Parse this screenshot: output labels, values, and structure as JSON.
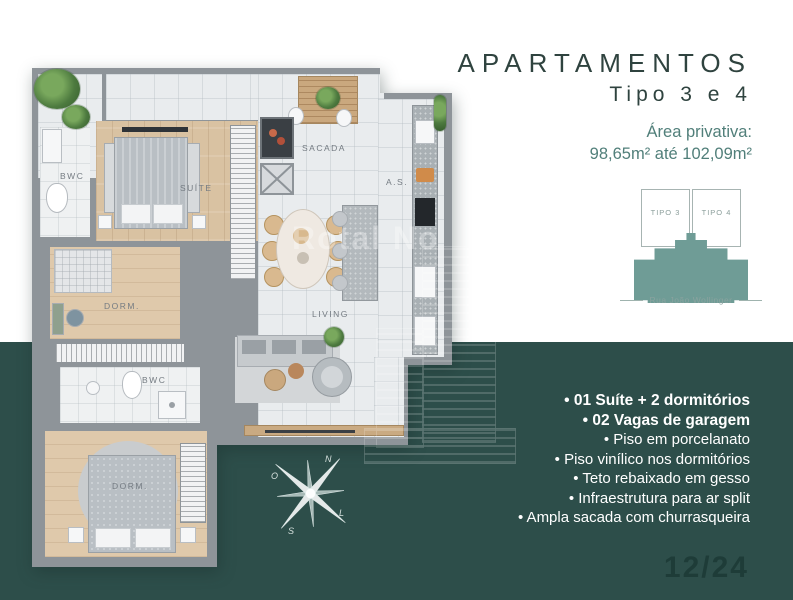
{
  "header": {
    "title": "APARTAMENTOS",
    "subtitle": "Tipo 3 e 4",
    "area_label": "Área privativa:",
    "area_value": "98,65m² até 102,09m²"
  },
  "keyplan": {
    "unit_left": "TIPO 3",
    "unit_right": "TIPO 4",
    "street": "Rua João Wollinger"
  },
  "features": [
    {
      "label": "• 01 Suíte + 2 dormitórios",
      "bold": true
    },
    {
      "label": "• 02 Vagas de garagem",
      "bold": true
    },
    {
      "label": "• Piso em porcelanato",
      "bold": false
    },
    {
      "label": "• Piso vinílico nos dormitórios",
      "bold": false
    },
    {
      "label": "• Teto rebaixado em gesso",
      "bold": false
    },
    {
      "label": "• Infraestrutura para ar split",
      "bold": false
    },
    {
      "label": "• Ampla sacada com churrasqueira",
      "bold": false
    }
  ],
  "floorplan": {
    "rooms": {
      "bwc_suite": "BWC",
      "suite": "SUÍTE",
      "sacada": "SACADA",
      "servico": "A.S.",
      "dorm_mid": "DORM.",
      "living": "LIVING",
      "bwc_social": "BWC",
      "dorm_bottom": "DORM."
    }
  },
  "compass": {
    "north": "N",
    "south": "S",
    "east": "L",
    "west": "O"
  },
  "watermark": {
    "text": "Rotal No"
  },
  "page_number": "12/24",
  "colors": {
    "background_teal": "#2d4e4a",
    "accent_teal": "#517f7a",
    "keyplan_fill": "#6f9c96",
    "title_color": "#2f433f",
    "wall_gray": "#8e9499",
    "wood_floor": "#d9c2a2"
  }
}
